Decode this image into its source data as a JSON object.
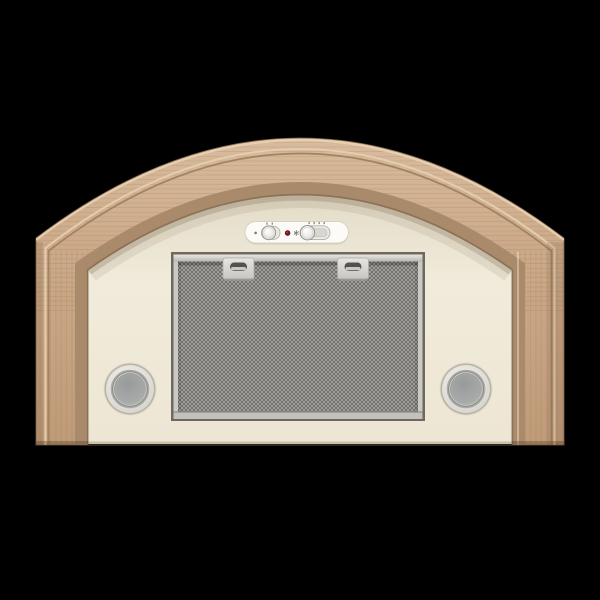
{
  "image": {
    "type": "product-photo",
    "subject": "Built-in cooker hood with arched light-oak wooden canopy frame, cream body, aluminium mesh grease filter, two round lamps and a slide-switch control panel",
    "background_color": "#000000",
    "width": 600,
    "height": 600
  },
  "product": {
    "canopy_frame": {
      "material": "light oak wood",
      "shape": "arched bridge with two vertical legs"
    },
    "body": {
      "finish": "cream enamel"
    },
    "control_panel": {
      "shape": "horizontal pill",
      "controls": [
        {
          "id": "lamp-dot-icon",
          "kind": "indicator glyph"
        },
        {
          "id": "light-switch",
          "kind": "2-position slide switch",
          "knob_position": "left"
        },
        {
          "id": "power-indicator-led",
          "kind": "round indicator lamp",
          "state": "off"
        },
        {
          "id": "fan-icon",
          "kind": "indicator glyph"
        },
        {
          "id": "fan-speed-switch",
          "kind": "multi-position slide switch",
          "knob_position": "left"
        }
      ]
    },
    "grease_filter": {
      "kind": "aluminium mesh",
      "latch_count": 2
    },
    "lamps": {
      "count": 2,
      "shape": "round",
      "positions": [
        "bottom-left",
        "bottom-right"
      ]
    }
  },
  "colors": {
    "bg": "#000000",
    "wood-1": "#d9bd9e",
    "wood-2": "#cdab8a",
    "wood-3": "#bf9b78",
    "wood-edge": "#7e6347",
    "wood-reveal": "#a98a6b",
    "wood-reveal-dark": "#8d7156",
    "wood-groove": "#a28360",
    "wood-highlight": "#e4ccae",
    "panel": "#f1ebdb",
    "panel-shadow": "#cfc7b2",
    "recess": "#6e695c",
    "metal-frame": "#cac9c5",
    "mesh-bg": "#b4b3af",
    "mesh-line": "#6f6e69",
    "latch": "#d8d7d3",
    "slot": "#55524b",
    "lamp-rim": "#b9b3a2",
    "lamp-bezel": "#e0dfdd",
    "lamp-ring": "#908f89",
    "lamp-lens": "#a7a9a8",
    "pill": "#fcfbf7",
    "pill-border": "#d7d2c2",
    "track": "#ebe9e3",
    "knob-border": "#96948c",
    "led": "#7e1c1c",
    "tick": "#918f88"
  }
}
